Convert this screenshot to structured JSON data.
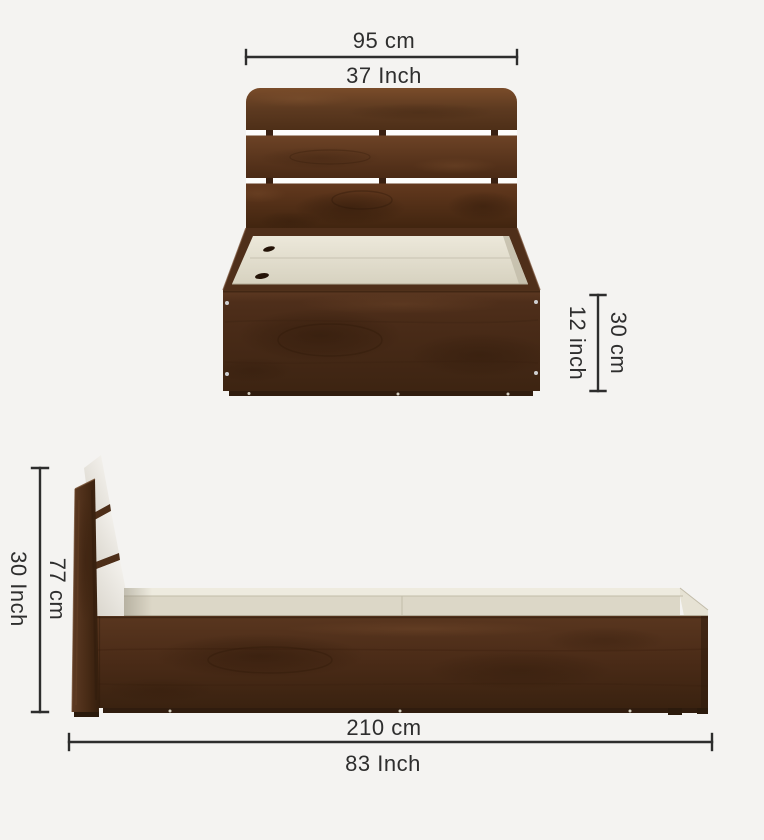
{
  "page": {
    "background_color": "#f4f3f1"
  },
  "colors": {
    "dimension_line": "#2d2d2d",
    "label_text": "#2e2e2e",
    "wood_dark": "#3a2210",
    "wood_mid": "#4e2e1a",
    "wood_light": "#7a4c2a",
    "deck_cream": "#dcd7c7",
    "headboard_back_white": "#f2f0ea"
  },
  "front_view": {
    "width_dimension": {
      "cm": "95 cm",
      "inch": "37 Inch"
    },
    "frame_height_dimension": {
      "cm": "30 cm",
      "inch": "12 inch"
    }
  },
  "side_view": {
    "headboard_height_dimension": {
      "cm": "77 cm",
      "inch": "30 Inch"
    },
    "length_dimension": {
      "cm": "210 cm",
      "inch": "83 Inch"
    }
  }
}
